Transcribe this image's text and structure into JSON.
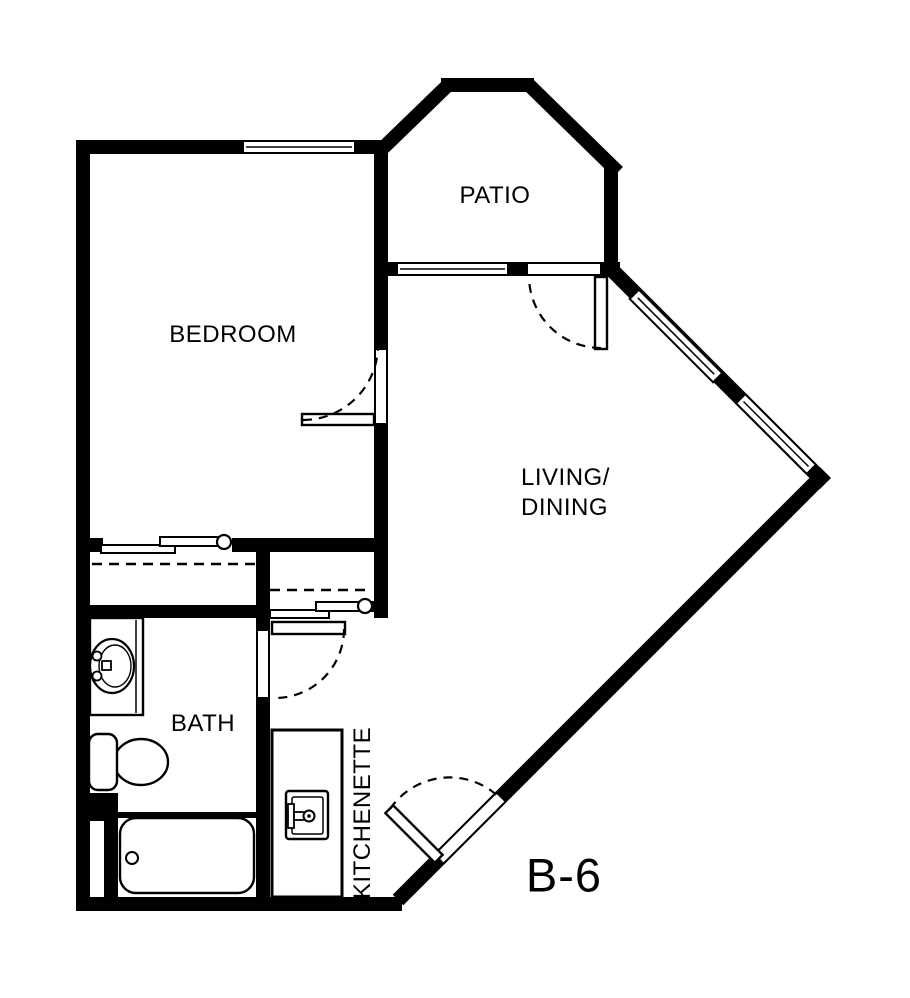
{
  "unit": {
    "label": "B-6"
  },
  "colors": {
    "line": "#000000",
    "background": "#ffffff"
  },
  "rooms": {
    "bedroom": {
      "label": "BEDROOM"
    },
    "patio": {
      "label": "PATIO"
    },
    "living_dining": {
      "line1": "LIVING/",
      "line2": "DINING"
    },
    "bath": {
      "label": "BATH"
    },
    "kitchenette": {
      "label": "KITCHENETTE"
    }
  },
  "fixtures": {
    "bath": [
      "vanity-sink",
      "toilet",
      "bathtub"
    ],
    "kitchenette": [
      "sink",
      "counter"
    ]
  },
  "features": {
    "doors": [
      "bedroom-door",
      "bath-door",
      "patio-door",
      "entry-door"
    ],
    "windows": [
      "bedroom-window",
      "patio-window",
      "living-window-upper",
      "living-window-lower"
    ],
    "closets": [
      "bedroom-closet",
      "living-closet"
    ]
  }
}
